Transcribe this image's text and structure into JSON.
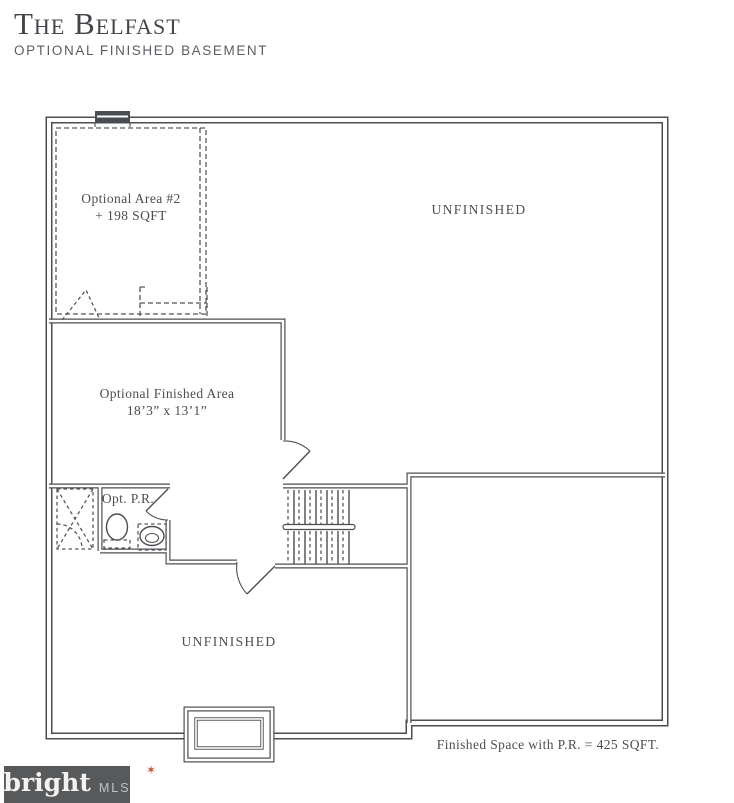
{
  "header": {
    "title": "The Belfast",
    "subtitle": "OPTIONAL FINISHED BASEMENT"
  },
  "plan": {
    "rooms": {
      "optional_area_2": {
        "name": "Optional Area #2",
        "area": "+ 198 SQFT"
      },
      "unfinished_top": {
        "name": "UNFINISHED"
      },
      "optional_finished_area": {
        "name": "Optional Finished Area",
        "dimensions": "18’3” x 13’1”"
      },
      "powder_room": {
        "name": "Opt. P.R."
      },
      "unfinished_bottom": {
        "name": "UNFINISHED"
      }
    },
    "note": "Finished Space with P.R. = 425 SQFT.",
    "features": [
      "window",
      "stairs",
      "toilet",
      "sink",
      "shower-rough-in",
      "egress-areaway"
    ]
  },
  "footer": {
    "logo": {
      "brand": "bright",
      "spark": "✶",
      "suffix": "MLS"
    }
  },
  "colors": {
    "line": "#4a4e52",
    "text": "#4a4e52",
    "logo_bg": "#58595b",
    "logo_accent": "#c0532f"
  }
}
